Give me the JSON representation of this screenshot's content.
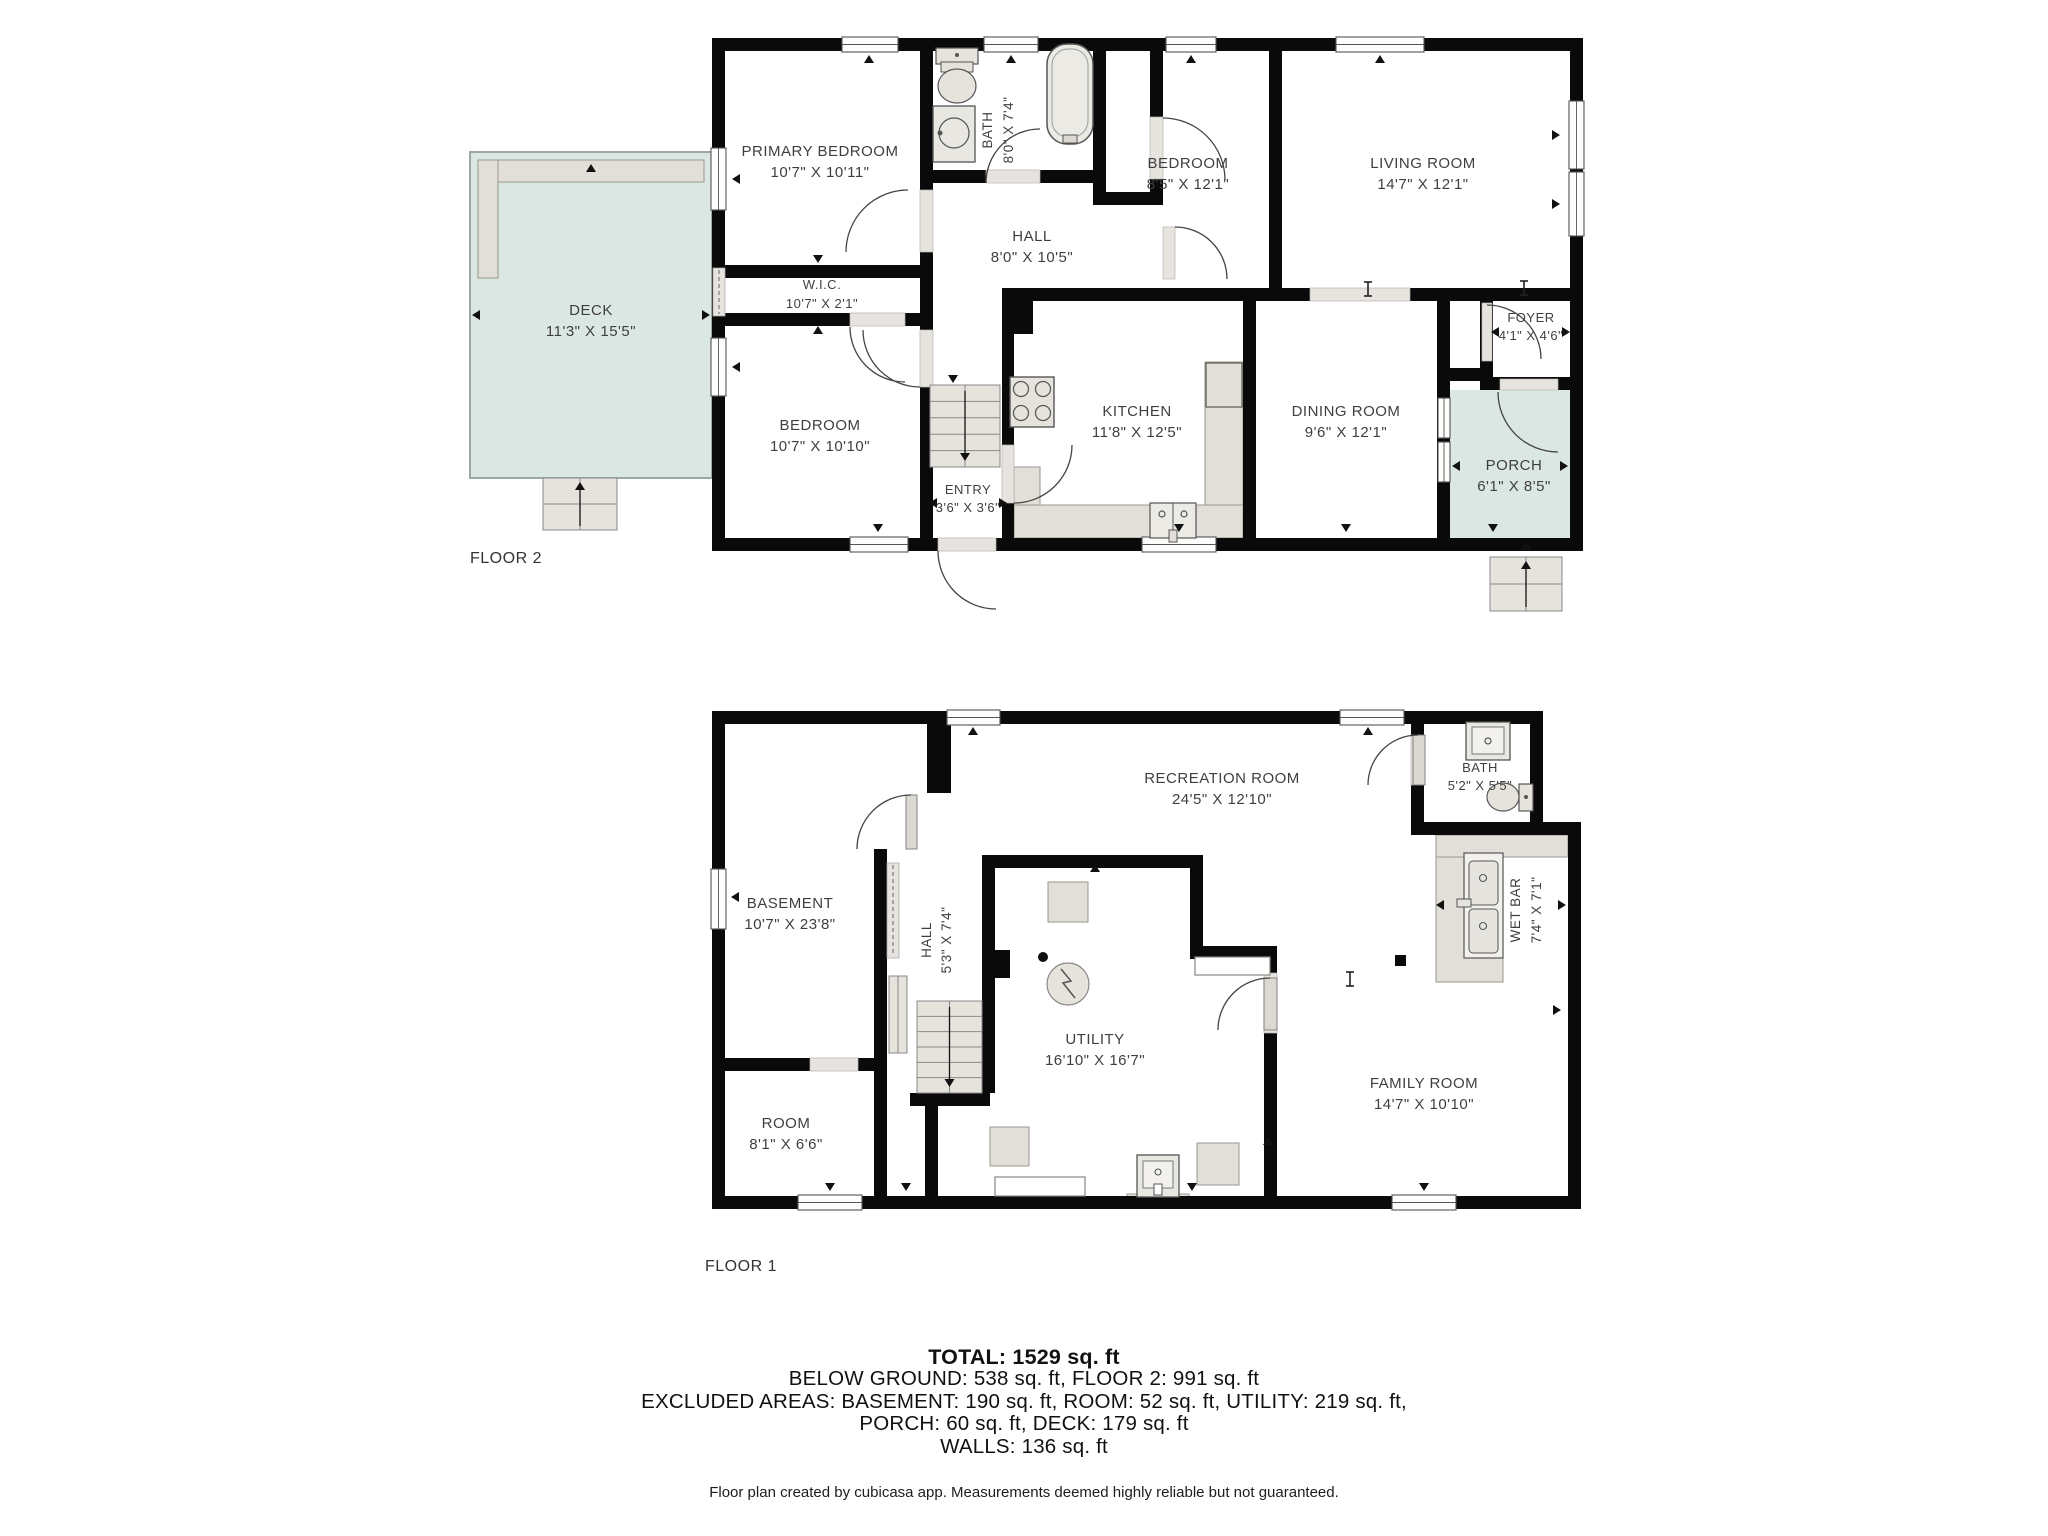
{
  "colors": {
    "wall": "#0a0a0a",
    "sill": "#e7e4df",
    "leaf": "#dcd9d3",
    "fixture": "#e2dfd9",
    "fixture_border": "#9b978f",
    "outdoor": "#dbe7e3",
    "outdoor_border": "#9aa7a2",
    "window_frame": "#4a4a4a",
    "arc": "#444444",
    "label": "#3f3f3f",
    "tick": "#111111"
  },
  "floors": [
    {
      "id": "floor2",
      "name": "FLOOR 2",
      "whites": [
        [
          725,
          51,
          845,
          487
        ]
      ],
      "outdoor": [
        {
          "x": 470,
          "y": 152,
          "w": 242,
          "h": 326,
          "border": true
        },
        {
          "x": 1450,
          "y": 390,
          "w": 120,
          "h": 148,
          "border": false
        }
      ],
      "counters": [
        [
          1014,
          505,
          229,
          33
        ],
        [
          1205,
          362,
          38,
          143
        ],
        [
          1014,
          467,
          26,
          38
        ],
        [
          478,
          160,
          226,
          22
        ],
        [
          478,
          160,
          20,
          118
        ]
      ],
      "walls": [
        [
          712,
          38,
          871,
          13
        ],
        [
          712,
          38,
          13,
          513
        ],
        [
          712,
          538,
          871,
          13
        ],
        [
          1570,
          38,
          13,
          513
        ],
        [
          920,
          38,
          13,
          513
        ],
        [
          712,
          265,
          221,
          13
        ],
        [
          712,
          313,
          221,
          13
        ],
        [
          920,
          170,
          186,
          13
        ],
        [
          1093,
          38,
          13,
          167
        ],
        [
          1150,
          38,
          13,
          162
        ],
        [
          1093,
          192,
          70,
          13
        ],
        [
          1269,
          38,
          13,
          263
        ],
        [
          1002,
          288,
          581,
          13
        ],
        [
          1002,
          288,
          31,
          46
        ],
        [
          1002,
          301,
          12,
          250
        ],
        [
          1243,
          301,
          13,
          250
        ],
        [
          1437,
          288,
          13,
          263
        ],
        [
          1480,
          301,
          13,
          80
        ],
        [
          1437,
          368,
          56,
          13
        ],
        [
          1480,
          377,
          103,
          13
        ]
      ],
      "sills": [
        [
          920,
          190,
          13,
          62
        ],
        [
          850,
          313,
          55,
          13
        ],
        [
          920,
          330,
          13,
          57
        ],
        [
          986,
          170,
          54,
          13
        ],
        [
          1150,
          117,
          13,
          62
        ],
        [
          1002,
          445,
          12,
          58
        ],
        [
          1310,
          288,
          100,
          13
        ],
        [
          938,
          538,
          58,
          13
        ],
        [
          1482,
          303,
          10,
          58
        ],
        [
          1500,
          379,
          58,
          11
        ],
        [
          1163,
          227,
          12,
          52
        ]
      ],
      "pockets": [
        [
          713,
          268,
          12,
          48
        ]
      ],
      "windows": [
        [
          842,
          37,
          56,
          15,
          "h"
        ],
        [
          984,
          37,
          54,
          15,
          "h"
        ],
        [
          1166,
          37,
          50,
          15,
          "h"
        ],
        [
          1336,
          37,
          88,
          15,
          "h"
        ],
        [
          711,
          148,
          15,
          62,
          "v"
        ],
        [
          711,
          338,
          15,
          58,
          "v"
        ],
        [
          1569,
          101,
          15,
          68,
          "v"
        ],
        [
          1569,
          172,
          15,
          64,
          "v"
        ],
        [
          850,
          537,
          58,
          15,
          "h"
        ],
        [
          1142,
          537,
          74,
          15,
          "h"
        ],
        [
          1438,
          398,
          12,
          40,
          "v"
        ],
        [
          1438,
          442,
          12,
          40,
          "v"
        ]
      ],
      "leaves": [],
      "arcs": [
        "M 846 252 A 62 62 0 0 1 908 190",
        "M 850 327 A 55 55 0 0 0 905 382",
        "M 863 330 A 57 57 0 0 0 920 387",
        "M 986 183 A 54 54 0 0 1 1040 129",
        "M 1163 118 A 62 62 0 0 1 1225 180",
        "M 1175 227 A 52 52 0 0 1 1227 279",
        "M 1072 445 A 58 58 0 0 1 1014 503",
        "M 938 551 A 58 58 0 0 0 996 609",
        "M 1487 305 A 54 54 0 0 1 1541 359",
        "M 1498 392 A 60 60 0 0 0 1558 452"
      ],
      "stairs": [
        {
          "x": 930,
          "y": 385,
          "w": 70,
          "h": 82,
          "rows": 5,
          "arr": "d"
        },
        {
          "x": 543,
          "y": 478,
          "w": 74,
          "h": 52,
          "rows": 2,
          "cols": 2,
          "arr": "u"
        },
        {
          "x": 1490,
          "y": 557,
          "w": 72,
          "h": 54,
          "rows": 2,
          "cols": 2,
          "arr": "u"
        }
      ],
      "fixtures": [
        {
          "t": "toiletV",
          "x": 936,
          "y": 48
        },
        {
          "t": "sinkSq",
          "x": 933,
          "y": 106
        },
        {
          "t": "tub",
          "x": 1047,
          "y": 44
        },
        {
          "t": "stove",
          "x": 1010,
          "y": 377
        },
        {
          "t": "sink2",
          "x": 1150,
          "y": 503
        },
        {
          "t": "orect",
          "x": 1206,
          "y": 363,
          "w": 36,
          "h": 44
        }
      ],
      "ibeams": [
        [
          1368,
          289
        ],
        [
          1524,
          288
        ]
      ],
      "ticks": [
        [
          869,
          59,
          "u"
        ],
        [
          1011,
          59,
          "u"
        ],
        [
          1191,
          59,
          "u"
        ],
        [
          1380,
          59,
          "u"
        ],
        [
          736,
          179,
          "l"
        ],
        [
          736,
          367,
          "l"
        ],
        [
          1556,
          135,
          "r"
        ],
        [
          1556,
          204,
          "r"
        ],
        [
          878,
          528,
          "d"
        ],
        [
          1179,
          528,
          "d"
        ],
        [
          1346,
          528,
          "d"
        ],
        [
          1493,
          528,
          "d"
        ],
        [
          953,
          379,
          "d"
        ],
        [
          818,
          259,
          "d"
        ],
        [
          818,
          330,
          "u"
        ],
        [
          933,
          503,
          "l"
        ],
        [
          1003,
          503,
          "r"
        ],
        [
          1495,
          332,
          "l"
        ],
        [
          1566,
          332,
          "r"
        ],
        [
          476,
          315,
          "l"
        ],
        [
          706,
          315,
          "r"
        ],
        [
          591,
          168,
          "u"
        ],
        [
          1456,
          466,
          "l"
        ],
        [
          1564,
          466,
          "r"
        ],
        [
          1526,
          546,
          "u"
        ]
      ],
      "labels": [
        {
          "x": 820,
          "y": 156,
          "l": [
            "PRIMARY BEDROOM",
            "10'7\" X 10'11\""
          ]
        },
        {
          "x": 822,
          "y": 289,
          "s": 13,
          "dy": 19,
          "l": [
            "W.I.C.",
            "10'7\" X 2'1\""
          ]
        },
        {
          "x": 820,
          "y": 430,
          "l": [
            "BEDROOM",
            "10'7\" X 10'10\""
          ]
        },
        {
          "x": 992,
          "y": 130,
          "r": -90,
          "s": 13.5,
          "l": [
            "BATH"
          ]
        },
        {
          "x": 1013,
          "y": 130,
          "r": -90,
          "s": 13.5,
          "l": [
            "8'0\" X 7'4\""
          ]
        },
        {
          "x": 1032,
          "y": 241,
          "l": [
            "HALL",
            "8'0\" X 10'5\""
          ]
        },
        {
          "x": 1188,
          "y": 168,
          "l": [
            "BEDROOM",
            "8'5\" X 12'1\""
          ]
        },
        {
          "x": 1423,
          "y": 168,
          "l": [
            "LIVING ROOM",
            "14'7\" X 12'1\""
          ]
        },
        {
          "x": 1137,
          "y": 416,
          "l": [
            "KITCHEN",
            "11'8\" X 12'5\""
          ]
        },
        {
          "x": 1346,
          "y": 416,
          "l": [
            "DINING ROOM",
            "9'6\" X 12'1\""
          ]
        },
        {
          "x": 1531,
          "y": 322,
          "s": 13,
          "dy": 18,
          "l": [
            "FOYER",
            "4'1\" X 4'6\""
          ]
        },
        {
          "x": 968,
          "y": 494,
          "s": 13,
          "dy": 18,
          "l": [
            "ENTRY",
            "3'6\" X 3'6\""
          ]
        },
        {
          "x": 1514,
          "y": 470,
          "l": [
            "PORCH",
            "6'1\" X 8'5\""
          ]
        },
        {
          "x": 591,
          "y": 315,
          "l": [
            "DECK",
            "11'3\" X 15'5\""
          ]
        },
        {
          "x": 470,
          "y": 563,
          "s": 16,
          "a": "start",
          "c": "#333333",
          "l": [
            "FLOOR 2"
          ]
        }
      ]
    },
    {
      "id": "floor1",
      "name": "FLOOR 1",
      "whites": [
        [
          725,
          724,
          699,
          472
        ],
        [
          1424,
          724,
          106,
          98
        ],
        [
          1424,
          835,
          144,
          361
        ]
      ],
      "outdoor": [],
      "counters": [
        [
          1436,
          835,
          132,
          22
        ],
        [
          1436,
          857,
          67,
          125
        ],
        [
          1127,
          1194,
          62,
          12
        ]
      ],
      "walls": [
        [
          712,
          711,
          712,
          13
        ],
        [
          1411,
          711,
          132,
          13
        ],
        [
          1411,
          711,
          13,
          124
        ],
        [
          1530,
          711,
          13,
          124
        ],
        [
          1411,
          822,
          170,
          13
        ],
        [
          712,
          711,
          13,
          498
        ],
        [
          712,
          1196,
          869,
          13
        ],
        [
          1568,
          822,
          13,
          387
        ],
        [
          927,
          724,
          24,
          69
        ],
        [
          874,
          849,
          13,
          360
        ],
        [
          712,
          1058,
          175,
          13
        ],
        [
          910,
          1093,
          80,
          13
        ],
        [
          925,
          1106,
          13,
          103
        ],
        [
          982,
          855,
          13,
          238
        ],
        [
          982,
          855,
          221,
          13
        ],
        [
          1190,
          855,
          13,
          104
        ],
        [
          1190,
          946,
          87,
          13
        ],
        [
          1264,
          946,
          13,
          263
        ]
      ],
      "sills": [
        [
          810,
          1058,
          48,
          13
        ],
        [
          1411,
          735,
          13,
          50
        ],
        [
          1264,
          973,
          13,
          60
        ]
      ],
      "pockets": [
        [
          887,
          863,
          12,
          95
        ]
      ],
      "windows": [
        [
          947,
          710,
          53,
          15,
          "h"
        ],
        [
          1340,
          710,
          64,
          15,
          "h"
        ],
        [
          711,
          869,
          15,
          60,
          "v"
        ],
        [
          798,
          1195,
          64,
          15,
          "h"
        ],
        [
          1392,
          1195,
          64,
          15,
          "h"
        ]
      ],
      "leaves": [
        [
          906,
          795,
          11,
          54
        ],
        [
          1413,
          735,
          12,
          50
        ],
        [
          1264,
          978,
          13,
          52
        ]
      ],
      "arcs": [
        "M 857 849 A 54 54 0 0 1 911 795",
        "M 1368 785 A 50 50 0 0 1 1418 735",
        "M 1218 1030 A 52 52 0 0 1 1270 978"
      ],
      "stairs": [
        {
          "x": 917,
          "y": 1001,
          "w": 65,
          "h": 92,
          "rows": 6,
          "arr": "d"
        },
        {
          "x": 889,
          "y": 976,
          "w": 18,
          "h": 77,
          "rows": 1
        }
      ],
      "fixtures": [
        {
          "t": "rect",
          "x": 1048,
          "y": 882,
          "w": 40,
          "h": 40
        },
        {
          "t": "black",
          "x": 982,
          "y": 950,
          "w": 28,
          "h": 28
        },
        {
          "t": "dot",
          "x": 1043,
          "y": 957,
          "rr": 5
        },
        {
          "t": "fan",
          "x": 1068,
          "y": 984,
          "rr": 21
        },
        {
          "t": "rect",
          "x": 990,
          "y": 1127,
          "w": 39,
          "h": 39
        },
        {
          "t": "rect",
          "x": 1197,
          "y": 1143,
          "w": 42,
          "h": 42
        },
        {
          "t": "lsink",
          "x": 1137,
          "y": 1155
        },
        {
          "t": "worect",
          "x": 995,
          "y": 1177,
          "w": 90,
          "h": 19
        },
        {
          "t": "worect",
          "x": 1195,
          "y": 957,
          "w": 75,
          "h": 18
        },
        {
          "t": "wbcounter",
          "x": 1464,
          "y": 853
        },
        {
          "t": "sinkTop",
          "x": 1466,
          "y": 722
        },
        {
          "t": "toiletH",
          "x": 1488,
          "y": 782
        },
        {
          "t": "black",
          "x": 1395,
          "y": 955,
          "w": 11,
          "h": 11
        }
      ],
      "ibeams": [
        [
          1350,
          979
        ]
      ],
      "ticks": [
        [
          973,
          731,
          "u"
        ],
        [
          1368,
          731,
          "u"
        ],
        [
          735,
          897,
          "l"
        ],
        [
          830,
          1187,
          "d"
        ],
        [
          906,
          1187,
          "d"
        ],
        [
          1192,
          1187,
          "d"
        ],
        [
          1424,
          1187,
          "d"
        ],
        [
          1557,
          1010,
          "r"
        ],
        [
          1440,
          905,
          "l"
        ],
        [
          1562,
          905,
          "r"
        ],
        [
          1095,
          868,
          "u"
        ],
        [
          1268,
          1141,
          "u"
        ]
      ],
      "labels": [
        {
          "x": 790,
          "y": 908,
          "l": [
            "BASEMENT",
            "10'7\" X 23'8\""
          ]
        },
        {
          "x": 931,
          "y": 940,
          "r": -90,
          "s": 13.5,
          "l": [
            "HALL"
          ]
        },
        {
          "x": 951,
          "y": 940,
          "r": -90,
          "s": 13.5,
          "l": [
            "5'3\" X 7'4\""
          ]
        },
        {
          "x": 1222,
          "y": 783,
          "l": [
            "RECREATION ROOM",
            "24'5\" X 12'10\""
          ]
        },
        {
          "x": 1480,
          "y": 772,
          "s": 13,
          "dy": 18,
          "l": [
            "BATH",
            "5'2\" X 5'5\""
          ]
        },
        {
          "x": 1520,
          "y": 910,
          "r": -90,
          "s": 13.5,
          "l": [
            "WET BAR"
          ]
        },
        {
          "x": 1541,
          "y": 910,
          "r": -90,
          "s": 13.5,
          "l": [
            "7'4\" X 7'1\""
          ]
        },
        {
          "x": 1095,
          "y": 1044,
          "l": [
            "UTILITY",
            "16'10\" X 16'7\""
          ]
        },
        {
          "x": 1424,
          "y": 1088,
          "l": [
            "FAMILY ROOM",
            "14'7\" X 10'10\""
          ]
        },
        {
          "x": 786,
          "y": 1128,
          "l": [
            "ROOM",
            "8'1\" X 6'6\""
          ]
        },
        {
          "x": 705,
          "y": 1271,
          "s": 16,
          "a": "start",
          "c": "#333333",
          "l": [
            "FLOOR 1"
          ]
        }
      ]
    }
  ],
  "summary": {
    "lines": [
      "TOTAL: 1529 sq. ft",
      "BELOW GROUND: 538 sq. ft, FLOOR 2: 991 sq. ft",
      "EXCLUDED AREAS: BASEMENT: 190 sq. ft, ROOM: 52 sq. ft, UTILITY: 219 sq. ft,",
      "PORCH: 60 sq. ft, DECK: 179 sq. ft",
      "WALLS: 136 sq. ft"
    ]
  },
  "footer": {
    "text": "Floor plan created by cubicasa app. Measurements deemed highly reliable but not guaranteed."
  }
}
